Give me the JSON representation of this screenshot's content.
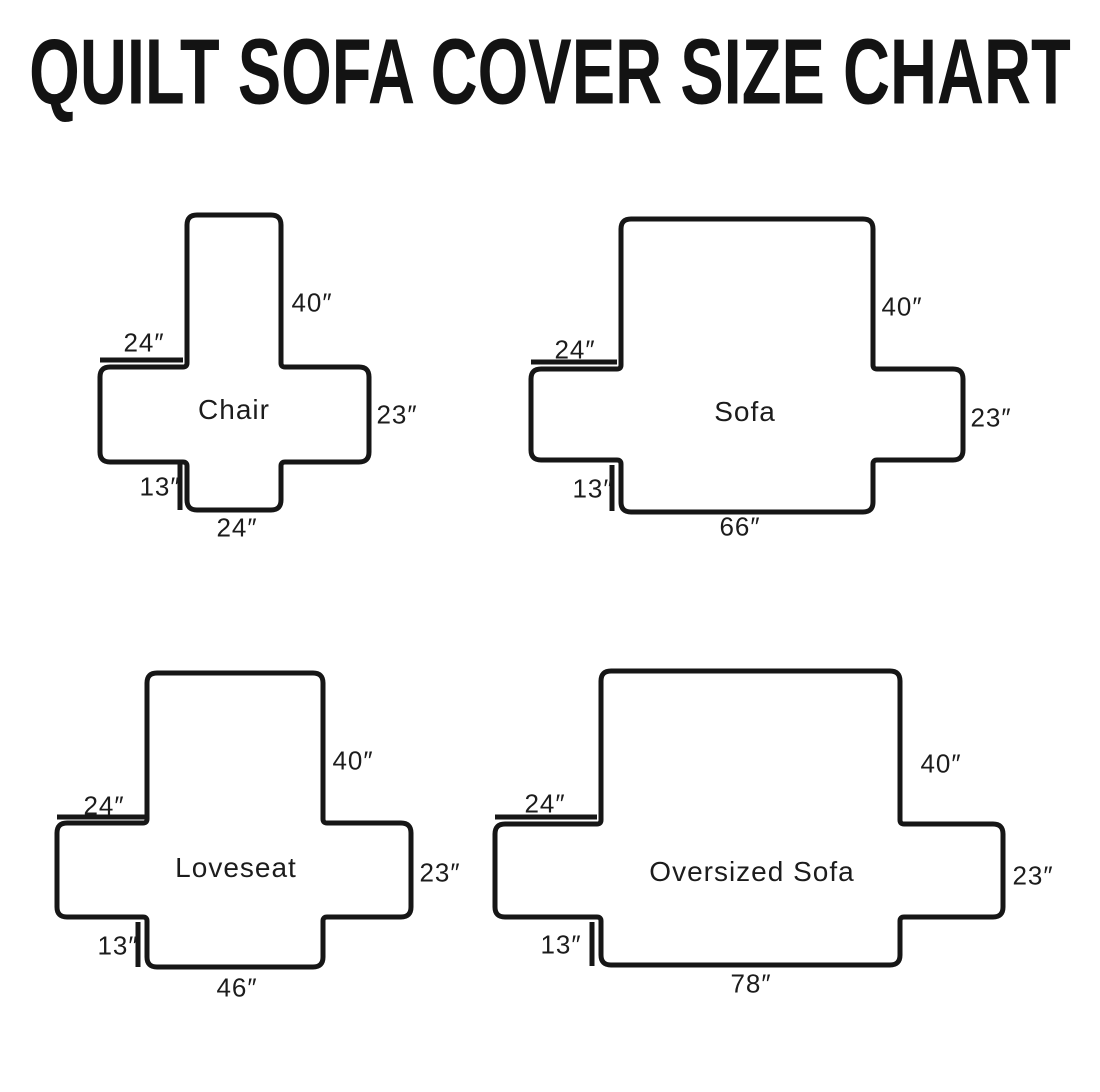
{
  "title": "QUILT SOFA COVER SIZE CHART",
  "canvas": {
    "width": 1100,
    "height": 1092,
    "background": "#ffffff",
    "line_color": "#161616",
    "line_width": 5,
    "outer_radius": 10,
    "inner_radius": 4
  },
  "diagrams": [
    {
      "id": "chair",
      "shape": {
        "back": {
          "x1": 187,
          "x2": 281,
          "top": 215
        },
        "band": {
          "x1": 100,
          "x2": 369,
          "top": 367,
          "bottom": 462
        },
        "front": {
          "x1": 187,
          "x2": 281,
          "bottom": 510
        }
      },
      "ticks": {
        "left_arm": {
          "x1": 100,
          "y1": 360,
          "x2": 183,
          "y2": 360
        },
        "front_skirt": {
          "x1": 180,
          "y1": 464,
          "x2": 180,
          "y2": 510
        }
      },
      "labels": {
        "back_height": {
          "text": "40″",
          "x": 312,
          "y": 303
        },
        "left_arm": {
          "text": "24″",
          "x": 144,
          "y": 343
        },
        "name": {
          "text": "Chair",
          "x": 234,
          "y": 410
        },
        "right_arm": {
          "text": "23″",
          "x": 397,
          "y": 415
        },
        "front_skirt": {
          "text": "13″",
          "x": 160,
          "y": 487
        },
        "bottom_width": {
          "text": "24″",
          "x": 237,
          "y": 528
        }
      }
    },
    {
      "id": "sofa",
      "shape": {
        "back": {
          "x1": 621,
          "x2": 873,
          "top": 219
        },
        "band": {
          "x1": 531,
          "x2": 963,
          "top": 369,
          "bottom": 460
        },
        "front": {
          "x1": 621,
          "x2": 873,
          "bottom": 512
        }
      },
      "ticks": {
        "left_arm": {
          "x1": 531,
          "y1": 362,
          "x2": 617,
          "y2": 362
        },
        "front_skirt": {
          "x1": 612,
          "y1": 465,
          "x2": 612,
          "y2": 511
        }
      },
      "labels": {
        "back_height": {
          "text": "40″",
          "x": 902,
          "y": 307
        },
        "left_arm": {
          "text": "24″",
          "x": 575,
          "y": 350
        },
        "name": {
          "text": "Sofa",
          "x": 745,
          "y": 412
        },
        "right_arm": {
          "text": "23″",
          "x": 991,
          "y": 418
        },
        "front_skirt": {
          "text": "13″",
          "x": 593,
          "y": 489
        },
        "bottom_width": {
          "text": "66″",
          "x": 740,
          "y": 527
        }
      }
    },
    {
      "id": "loveseat",
      "shape": {
        "back": {
          "x1": 147,
          "x2": 323,
          "top": 673
        },
        "band": {
          "x1": 57,
          "x2": 411,
          "top": 823,
          "bottom": 917
        },
        "front": {
          "x1": 147,
          "x2": 323,
          "bottom": 967
        }
      },
      "ticks": {
        "left_arm": {
          "x1": 57,
          "y1": 817,
          "x2": 145,
          "y2": 817
        },
        "front_skirt": {
          "x1": 138,
          "y1": 922,
          "x2": 138,
          "y2": 967
        }
      },
      "labels": {
        "back_height": {
          "text": "40″",
          "x": 353,
          "y": 761
        },
        "left_arm": {
          "text": "24″",
          "x": 104,
          "y": 806
        },
        "name": {
          "text": "Loveseat",
          "x": 236,
          "y": 868
        },
        "right_arm": {
          "text": "23″",
          "x": 440,
          "y": 873
        },
        "front_skirt": {
          "text": "13″",
          "x": 118,
          "y": 946
        },
        "bottom_width": {
          "text": "46″",
          "x": 237,
          "y": 988
        }
      }
    },
    {
      "id": "oversized-sofa",
      "shape": {
        "back": {
          "x1": 601,
          "x2": 900,
          "top": 671
        },
        "band": {
          "x1": 495,
          "x2": 1003,
          "top": 824,
          "bottom": 917
        },
        "front": {
          "x1": 601,
          "x2": 900,
          "bottom": 965
        }
      },
      "ticks": {
        "left_arm": {
          "x1": 495,
          "y1": 817,
          "x2": 597,
          "y2": 817
        },
        "front_skirt": {
          "x1": 592,
          "y1": 922,
          "x2": 592,
          "y2": 966
        }
      },
      "labels": {
        "back_height": {
          "text": "40″",
          "x": 941,
          "y": 764
        },
        "left_arm": {
          "text": "24″",
          "x": 545,
          "y": 804
        },
        "name": {
          "text": "Oversized Sofa",
          "x": 752,
          "y": 872
        },
        "right_arm": {
          "text": "23″",
          "x": 1033,
          "y": 876
        },
        "front_skirt": {
          "text": "13″",
          "x": 561,
          "y": 945
        },
        "bottom_width": {
          "text": "78″",
          "x": 751,
          "y": 984
        }
      }
    }
  ]
}
